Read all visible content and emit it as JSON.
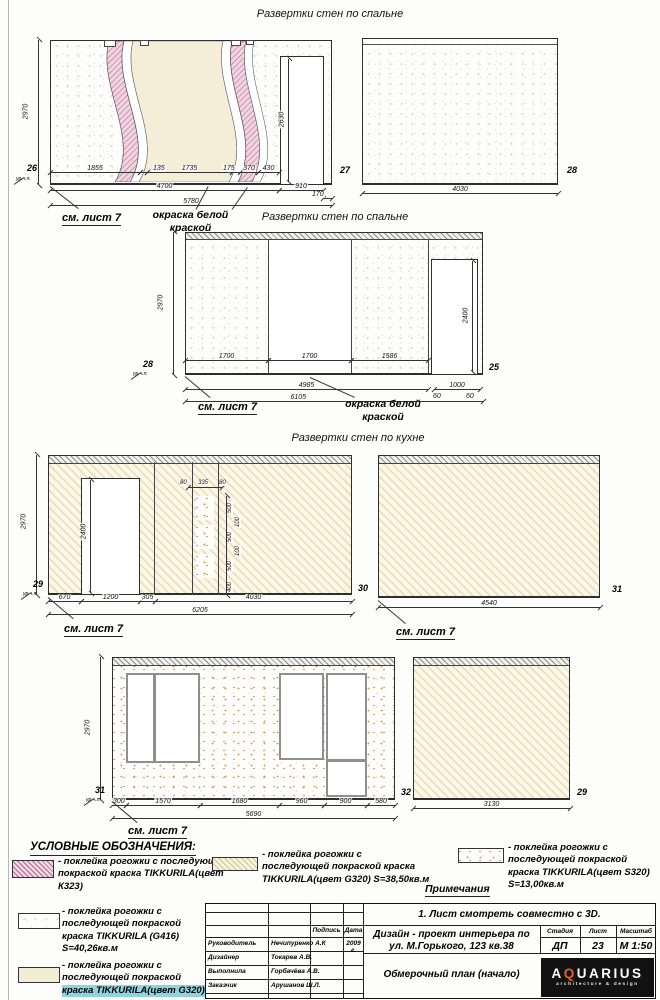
{
  "headings": {
    "row1": "Развертки стен по спальне",
    "row2": "Развертки стен по  спальне",
    "row3": "Развертки стен по кухне"
  },
  "labels": {
    "see_sheet": "см. лист 7",
    "paint": "окраска белой краской",
    "level": "ур.ч.п."
  },
  "marks": {
    "r1": [
      "26",
      "27",
      "28"
    ],
    "r2": [
      "28",
      "25"
    ],
    "r3": [
      "29",
      "30",
      "31"
    ],
    "r4": [
      "31",
      "32",
      "29"
    ]
  },
  "e1": {
    "height": "2970",
    "door_height": "2630",
    "chain": [
      "1855",
      "135",
      "1735",
      "175",
      "370",
      "430"
    ],
    "mid": [
      "4700",
      "910"
    ],
    "offset": "170",
    "total": "5780"
  },
  "e2": {
    "width": "4030"
  },
  "e3": {
    "height": "2970",
    "door_height": "2400",
    "chain": [
      "1700",
      "1700",
      "1586"
    ],
    "sub": "4985",
    "door_width": "1000",
    "gaps": [
      "60",
      "60"
    ],
    "total": "6105"
  },
  "e4": {
    "height": "2970",
    "door_height": "2400",
    "top": [
      "80",
      "335",
      "80"
    ],
    "stack": [
      "500",
      "100",
      "500",
      "100",
      "500",
      "400"
    ],
    "chain": [
      "670",
      "1200",
      "305",
      "4030"
    ],
    "total": "6205"
  },
  "e5": {
    "width": "4540"
  },
  "e6": {
    "height": "2970",
    "chain": [
      "300",
      "1570",
      "1680",
      "960",
      "900",
      "580"
    ],
    "total": "5690"
  },
  "e7": {
    "width": "3130"
  },
  "legend": {
    "title": "УСЛОВНЫЕ ОБОЗНАЧЕНИЯ:",
    "items": [
      {
        "swatch": "pink-hatch",
        "text": "- поклейка рогожки с последующей покраской краска TIKKURILA(цвет К323)"
      },
      {
        "swatch": "speckle",
        "text": "- поклейка рогожки с последующей покраской краска TIKKURILA (G416) S=40,26кв.м"
      },
      {
        "swatch": "beige",
        "text": "- поклейка рогожки с последующей покраской",
        "text2": "краска TIKKURILA(цвет G320)"
      },
      {
        "swatch": "beige-hatch",
        "text": "- поклейка рогожки с последующей покраской краска TIKKURILA(цвет G320) S=38,50кв.м"
      },
      {
        "swatch": "speckle-orange",
        "text": "- поклейка рогожки с последующей покраской краска TIKKURILA(цвет S320) S=13,00кв.м"
      }
    ]
  },
  "notes": {
    "title": "Примечания",
    "note1": "1. Лист смотреть совместно с 3D."
  },
  "titleblock": {
    "note": "1. Лист смотреть совместно с 3D.",
    "sign_header": "Подпись",
    "date_header": "Дата",
    "date_value": "2009 г.",
    "rows": [
      {
        "role": "Руководитель",
        "name": "Нечипуренко А.К"
      },
      {
        "role": "Дизайнер",
        "name": "Токарев А.В."
      },
      {
        "role": "Выполнила",
        "name": "Горбачёва А.В."
      },
      {
        "role": "Заказчик",
        "name": "Арушанов Ш.Л."
      }
    ],
    "project": "Дизайн - проект интерьера по ул. М.Горького, 123 кв.38",
    "doc_title": "Обмерочный план (начало)",
    "stage_header": "Стадия",
    "stage": "ДП",
    "sheet_header": "Лист",
    "sheet": "23",
    "scale_header": "Масштаб",
    "scale": "М 1:50",
    "logo_a": "A",
    "logo_q": "Q",
    "logo_rest": "UARIUS",
    "logo_sub": "architecture & design"
  },
  "colors": {
    "accent_orange": "#e8611d",
    "hatch_pink": "#b9678d",
    "wall_cream": "#fbf7e8",
    "highlight_cyan": "#8fd4dc"
  }
}
